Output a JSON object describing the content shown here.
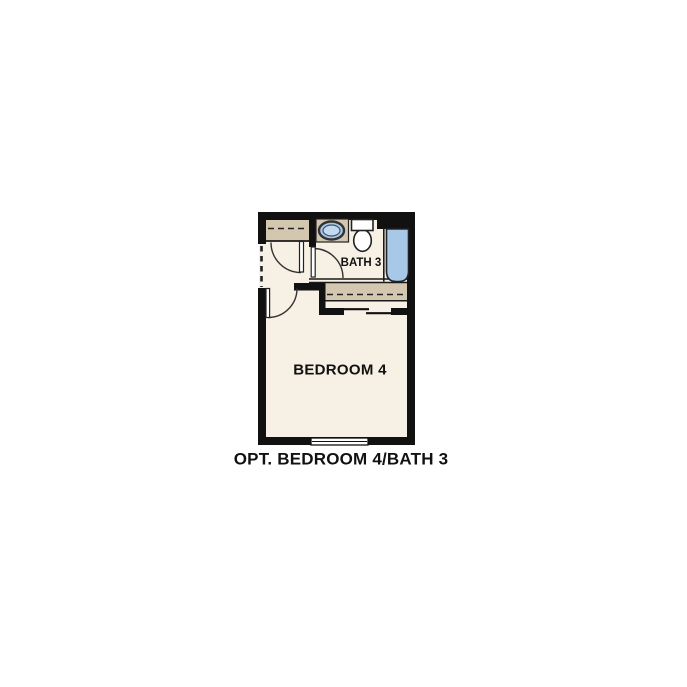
{
  "floor_plan": {
    "caption": "OPT. BEDROOM 4/BATH 3",
    "rooms": {
      "bedroom": {
        "label": "BEDROOM 4"
      },
      "bath": {
        "label": "BATH 3"
      }
    },
    "fixtures": [
      "bathtub",
      "toilet",
      "sink-vanity",
      "entry-closet-shelf",
      "bedroom-closet-shelf",
      "bypass-closet-doors",
      "window",
      "swing-door-closet",
      "swing-door-bath",
      "swing-door-bedroom",
      "dashed-wall-opening"
    ],
    "colors": {
      "background": "#FFFFFF",
      "wall_black": "#111111",
      "floor_cream": "#F7F0E4",
      "shelf_tan": "#D4C7B0",
      "fixture_blue": "#A8C8E8",
      "sink_inner_blue": "#C3D9F0",
      "fixture_white": "#FFFFFF"
    }
  }
}
